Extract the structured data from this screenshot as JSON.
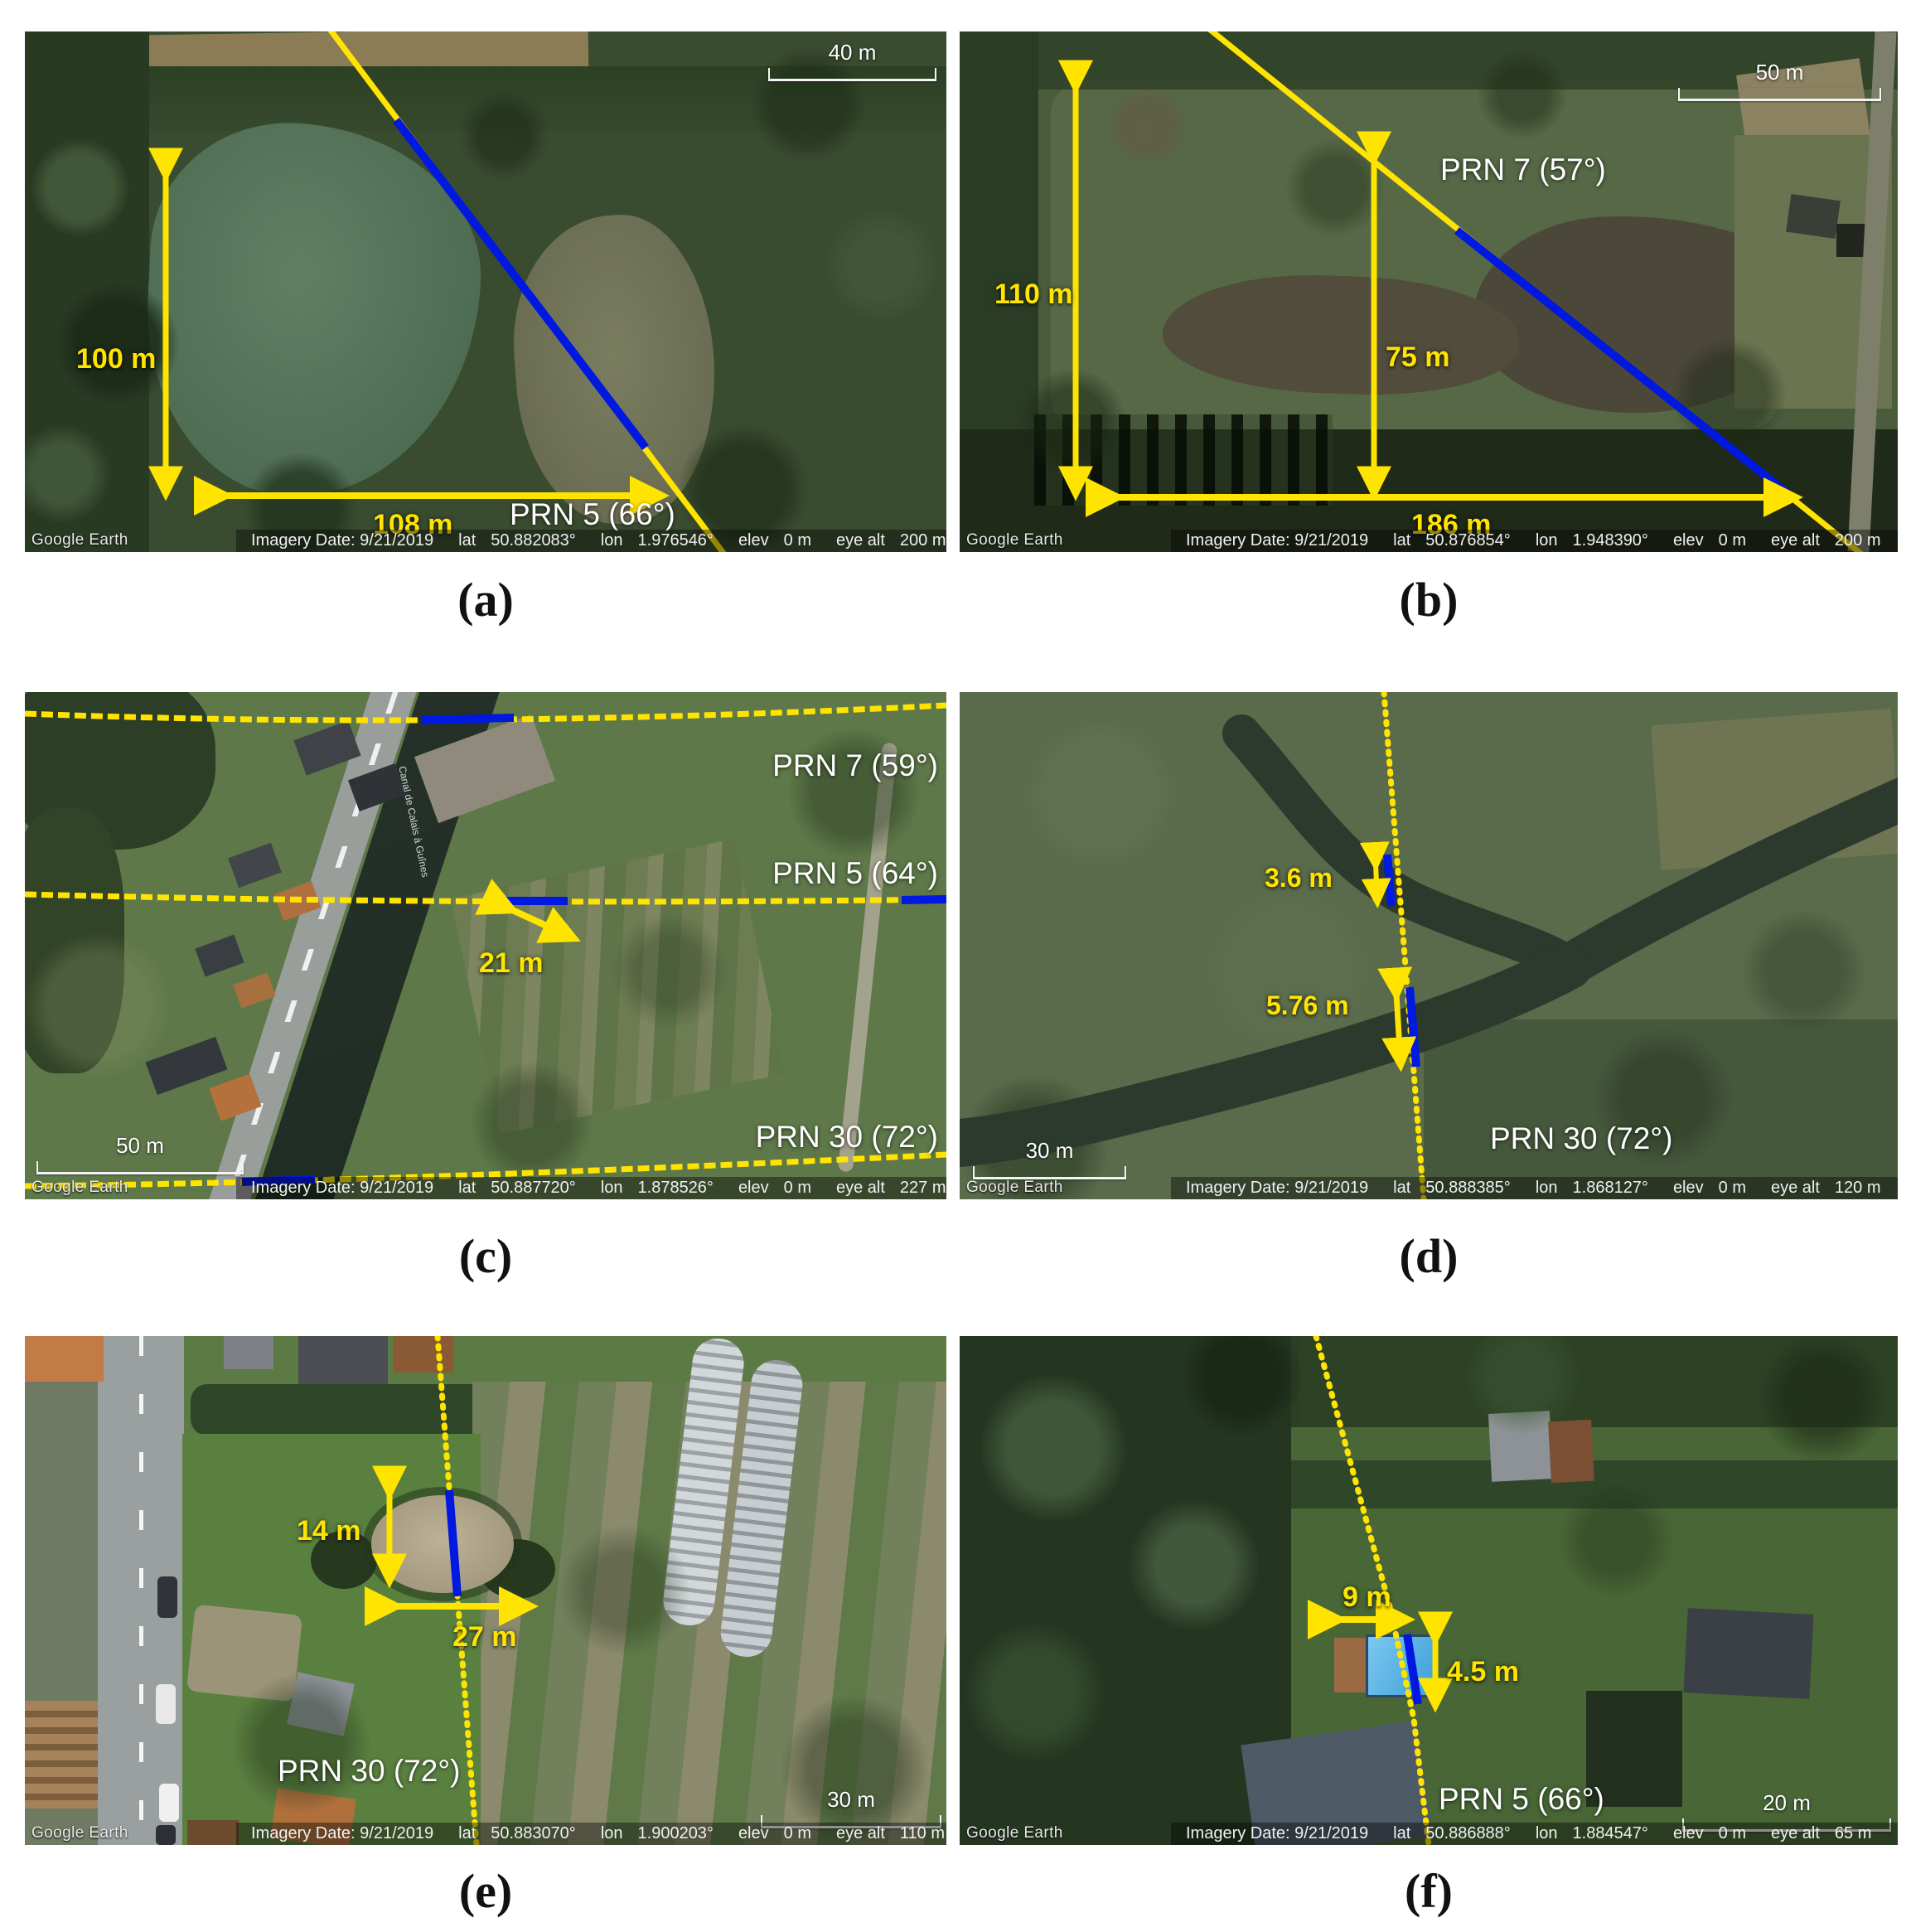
{
  "figure": {
    "colors": {
      "annotation_yellow": "#ffe400",
      "annotation_blue": "#0018e0",
      "label_white": "#ffffff"
    },
    "panels": [
      {
        "caption": "(a)",
        "scale_bar": "40 m",
        "watermark": "Google Earth",
        "prn": [
          "PRN 5 (66°)"
        ],
        "measurements": [
          "100 m",
          "108 m"
        ],
        "meta": {
          "date": "Imagery Date: 9/21/2019",
          "lat_label": "lat",
          "lat": "50.882083°",
          "lon_label": "lon",
          "lon": "1.976546°",
          "elev_label": "elev",
          "elev": "0 m",
          "eye_alt_label": "eye alt",
          "eye_alt": "200 m"
        }
      },
      {
        "caption": "(b)",
        "scale_bar": "50 m",
        "watermark": "Google Earth",
        "prn": [
          "PRN 7 (57°)"
        ],
        "measurements": [
          "110 m",
          "75 m",
          "186 m"
        ],
        "meta": {
          "date": "Imagery Date: 9/21/2019",
          "lat_label": "lat",
          "lat": "50.876854°",
          "lon_label": "lon",
          "lon": "1.948390°",
          "elev_label": "elev",
          "elev": "0 m",
          "eye_alt_label": "eye alt",
          "eye_alt": "200 m"
        }
      },
      {
        "caption": "(c)",
        "scale_bar": "50 m",
        "watermark": "Google Earth",
        "prn": [
          "PRN 7 (59°)",
          "PRN 5 (64°)",
          "PRN 30 (72°)"
        ],
        "measurements": [
          "21 m"
        ],
        "canal_label": "Canal de Calais à Guînes",
        "meta": {
          "date": "Imagery Date: 9/21/2019",
          "lat_label": "lat",
          "lat": "50.887720°",
          "lon_label": "lon",
          "lon": "1.878526°",
          "elev_label": "elev",
          "elev": "0 m",
          "eye_alt_label": "eye alt",
          "eye_alt": "227 m"
        }
      },
      {
        "caption": "(d)",
        "scale_bar": "30 m",
        "watermark": "Google Earth",
        "prn": [
          "PRN 30 (72°)"
        ],
        "measurements": [
          "3.6 m",
          "5.76 m"
        ],
        "meta": {
          "date": "Imagery Date: 9/21/2019",
          "lat_label": "lat",
          "lat": "50.888385°",
          "lon_label": "lon",
          "lon": "1.868127°",
          "elev_label": "elev",
          "elev": "0 m",
          "eye_alt_label": "eye alt",
          "eye_alt": "120 m"
        }
      },
      {
        "caption": "(e)",
        "scale_bar": "30 m",
        "watermark": "Google Earth",
        "prn": [
          "PRN 30 (72°)"
        ],
        "measurements": [
          "14 m",
          "27 m"
        ],
        "meta": {
          "date": "Imagery Date: 9/21/2019",
          "lat_label": "lat",
          "lat": "50.883070°",
          "lon_label": "lon",
          "lon": "1.900203°",
          "elev_label": "elev",
          "elev": "0 m",
          "eye_alt_label": "eye alt",
          "eye_alt": "110 m"
        }
      },
      {
        "caption": "(f)",
        "scale_bar": "20 m",
        "watermark": "Google Earth",
        "prn": [
          "PRN 5 (66°)"
        ],
        "measurements": [
          "9 m",
          "4.5 m"
        ],
        "meta": {
          "date": "Imagery Date: 9/21/2019",
          "lat_label": "lat",
          "lat": "50.886888°",
          "lon_label": "lon",
          "lon": "1.884547°",
          "elev_label": "elev",
          "elev": "0 m",
          "eye_alt_label": "eye alt",
          "eye_alt": "65 m"
        }
      }
    ]
  }
}
